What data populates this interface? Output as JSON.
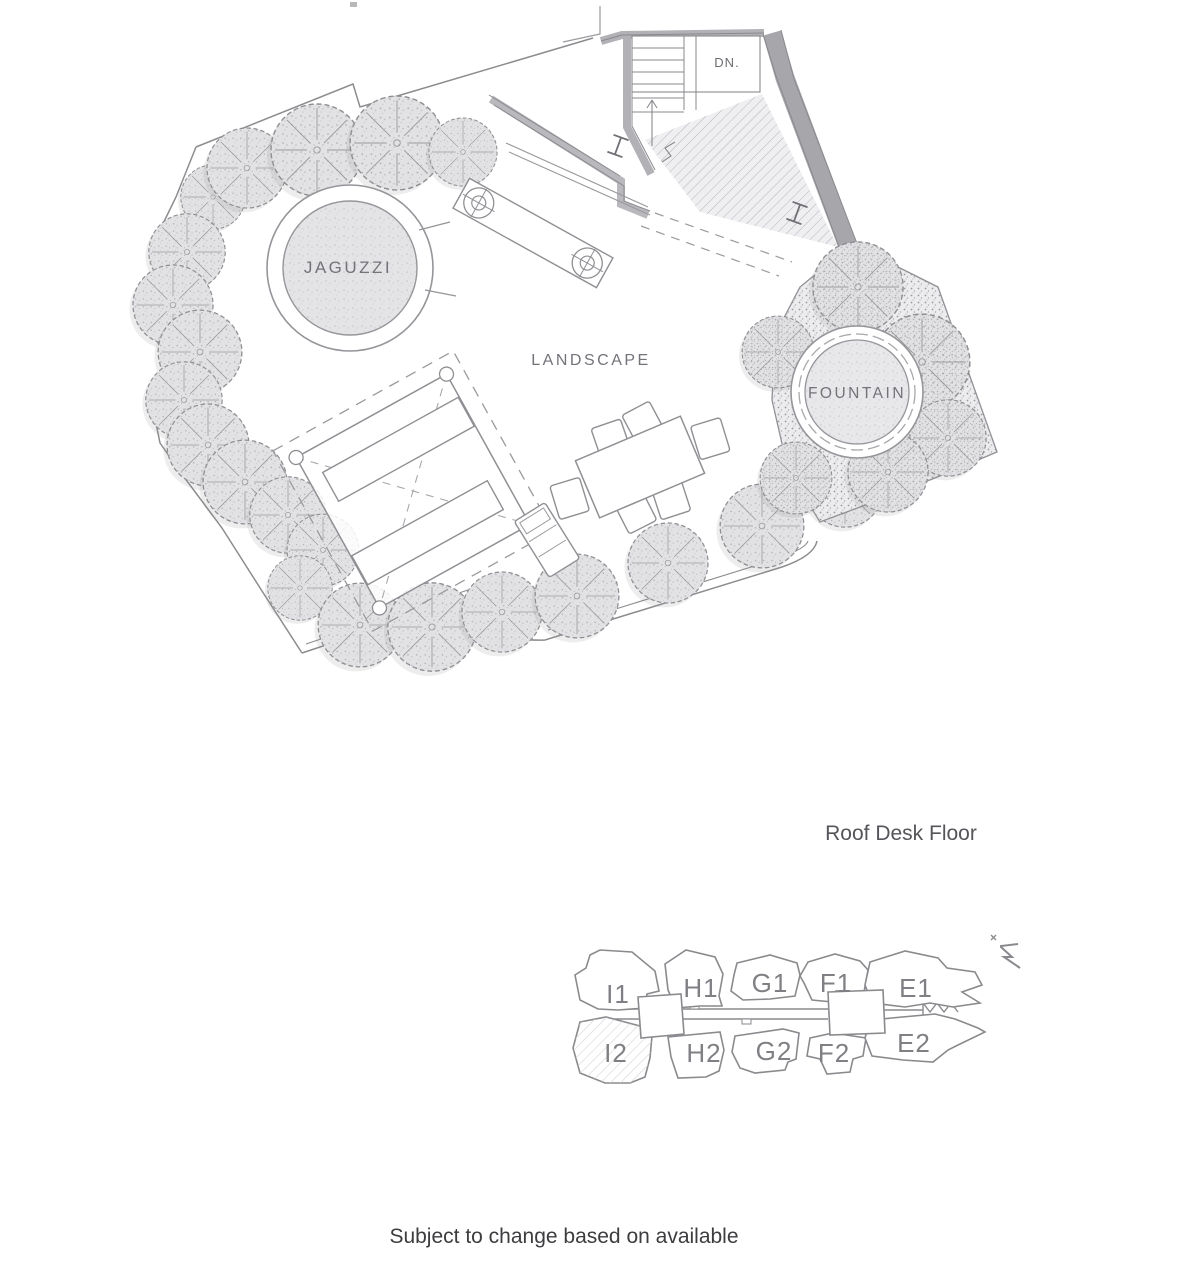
{
  "page": {
    "title": "Roof Desk Floor",
    "disclaimer": "Subject to change based on available"
  },
  "plan": {
    "labels": {
      "jacuzzi": "JAGUZZI",
      "landscape": "LANDSCAPE",
      "fountain": "FOUNTAIN",
      "stairs_down": "DN."
    }
  },
  "key_plan": {
    "units": [
      {
        "label": "I1"
      },
      {
        "label": "H1"
      },
      {
        "label": "G1"
      },
      {
        "label": "F1"
      },
      {
        "label": "E1"
      },
      {
        "label": "I2"
      },
      {
        "label": "H2"
      },
      {
        "label": "G2"
      },
      {
        "label": "F2"
      },
      {
        "label": "E2"
      }
    ],
    "highlighted_unit": "I2",
    "icons": {
      "north_arrow": "north-arrow-icon"
    }
  }
}
